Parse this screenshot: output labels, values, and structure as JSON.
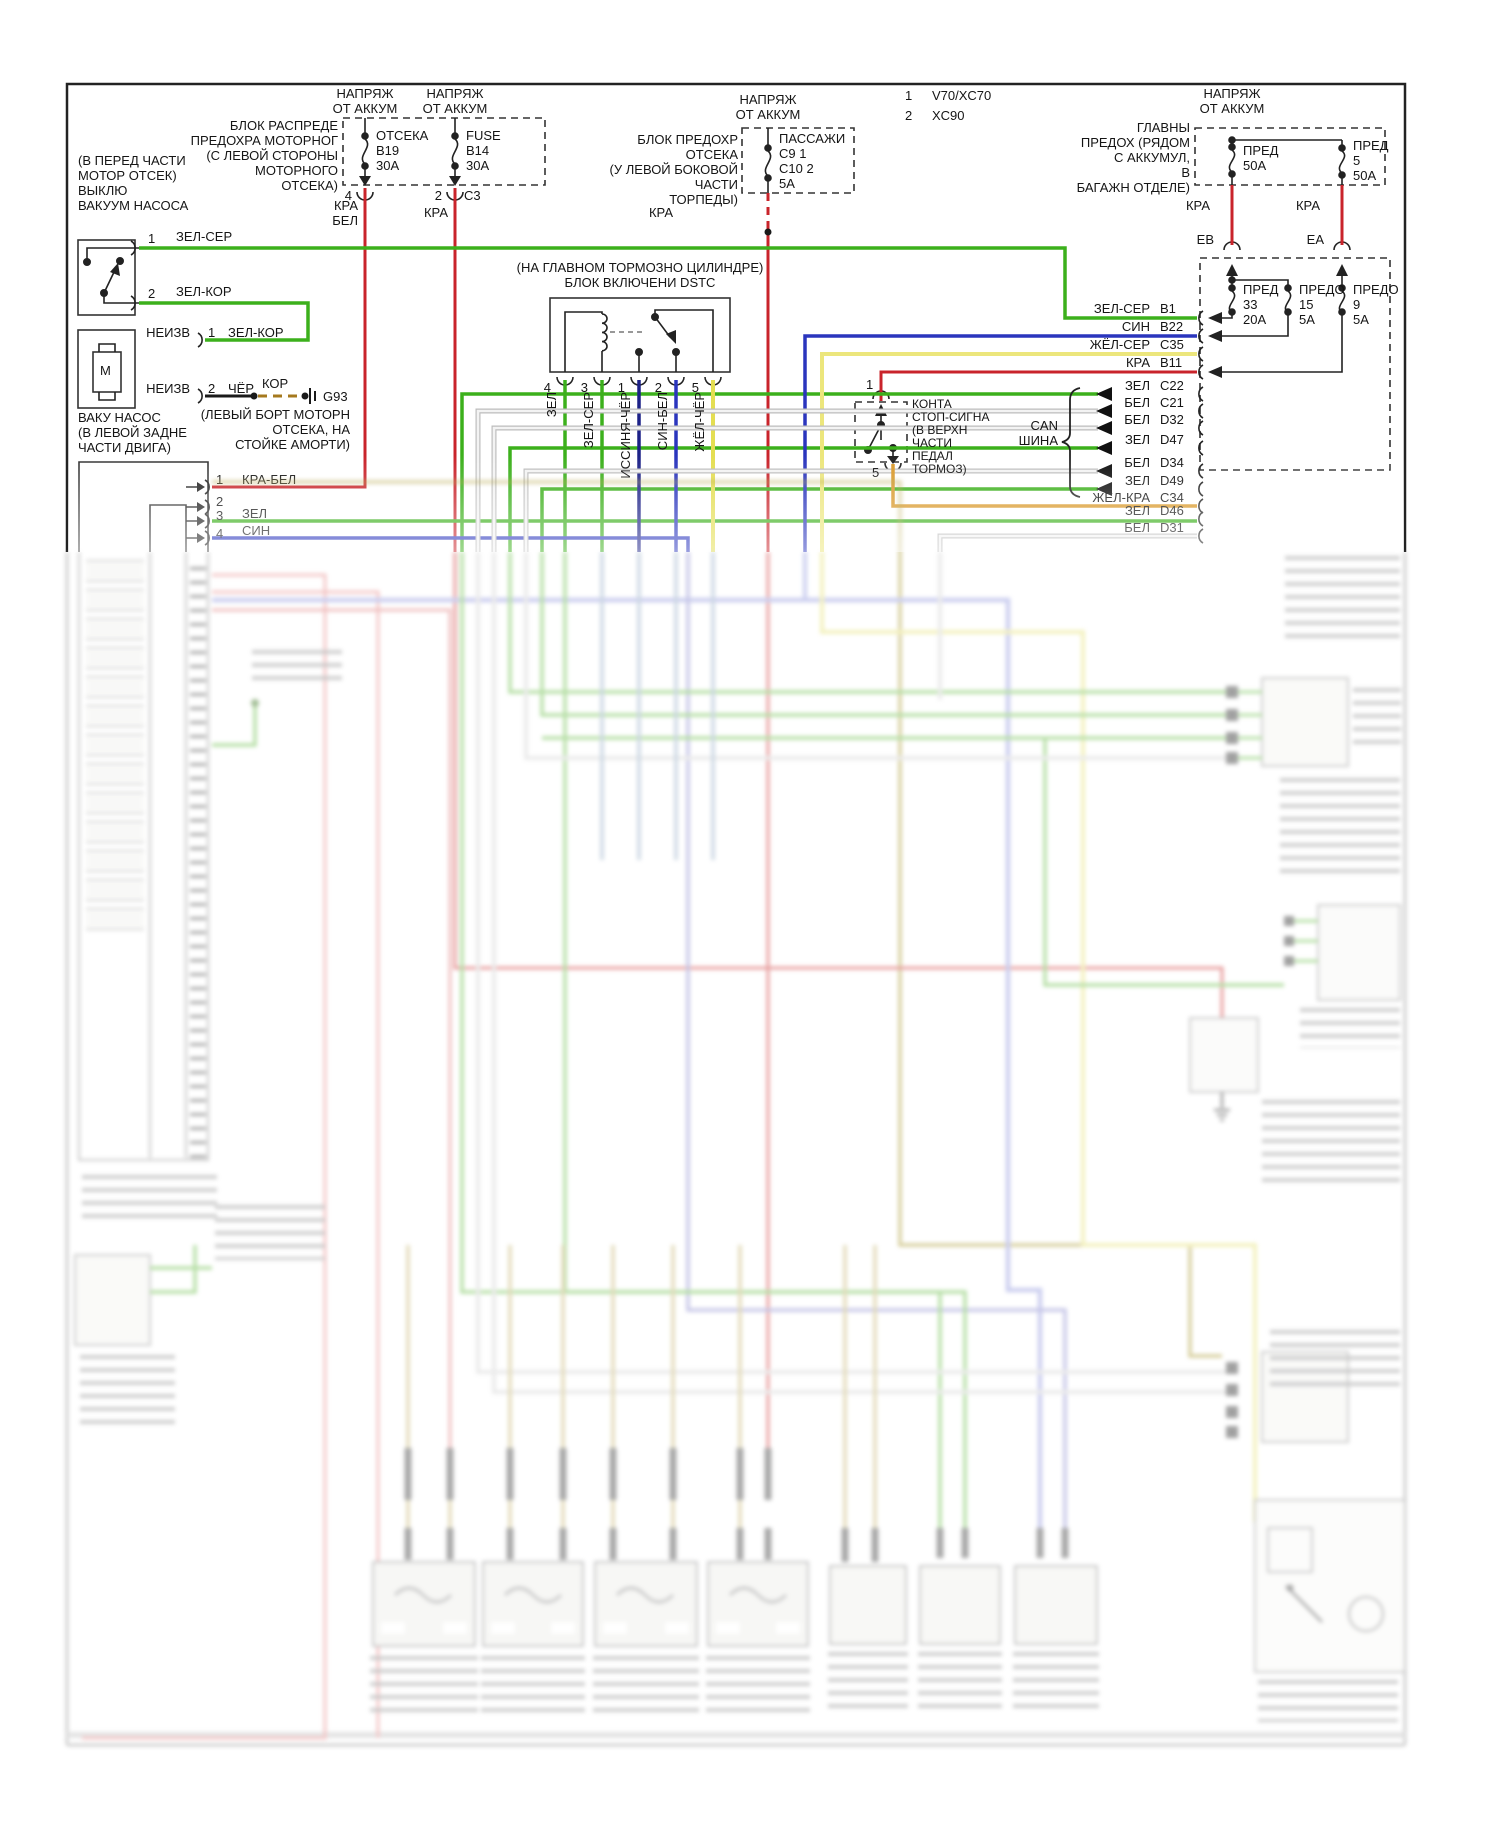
{
  "diagram": {
    "batt": "НАПРЯЖ\nОТ АККУМ",
    "legend": {
      "n1": "1",
      "v1": "V70/XC70",
      "n2": "2",
      "v2": "XC90"
    },
    "fb1": {
      "title": "БЛОК РАСПРЕДЕ\nПРЕДОХРА МОТОРНОГ\n(С ЛЕВОЙ СТОРОНЫ\nМОТОРНОГО\nОТСЕКА)",
      "f1": "ОТСЕКА\nB19\n30A",
      "f2": "FUSE\nB14\n30A",
      "p1": "4",
      "p2": "2",
      "c3": "C3",
      "w1": "КРА\nБЕЛ",
      "w2": "КРА"
    },
    "fb2": {
      "title": "БЛОК ПРЕДОХР\nОТСЕКА\n(У ЛЕВОЙ БОКОВОЙ\nЧАСТИ\nТОРПЕДЫ)",
      "f": "ПАССАЖИ\nC9   1\nC10  2\n5A",
      "w": "КРА"
    },
    "mf": {
      "title": "ГЛАВНЫ\nПРЕДОХ (РЯДОМ\nС АККУМУЛ,\nВ\nБАГАЖН ОТДЕЛЕ)",
      "f1": "ПРЕД\n50A",
      "f2": "ПРЕД\n5\n50A",
      "w": "КРА",
      "eb": "ЕВ",
      "ea": "ЕА"
    },
    "fb3": {
      "f1": "ПРЕД\n33\n20A",
      "f2": "ПРЕДО\n15\n5A",
      "f3": "ПРЕДО\n9\n5A"
    },
    "vsw": {
      "loc": "(В ПЕРЕД ЧАСТИ\nМОТОР ОТСЕК)\nВЫКЛЮ\nВАКУУМ НАСОСА",
      "p1": "1",
      "w1": "ЗЕЛ-СЕР",
      "p2": "2",
      "w2": "ЗЕЛ-КОР"
    },
    "pump": {
      "name": "ВАКУ НАСОС\n(В ЛЕВОЙ ЗАДНЕ\nЧАСТИ ДВИГА)",
      "m": "М",
      "u": "НЕИЗВ",
      "p1": "1",
      "w1": "ЗЕЛ-КОР",
      "p2": "2",
      "w2": "ЧЁР",
      "kor": "КОР",
      "gnd": "G93",
      "gnd_loc": "(ЛЕВЫЙ БОРТ МОТОРН\nОТСЕКА, НА\nСТОЙКЕ АМОРТИ)"
    },
    "ecu": {
      "p1": "1",
      "w1": "КРА-БЕЛ",
      "p2": "2",
      "p3": "3",
      "w3": "ЗЕЛ",
      "p4": "4",
      "w4": "СИН"
    },
    "dstc": {
      "title": "(НА ГЛАВНОМ ТОРМОЗНО ЦИЛИНДРЕ)\nБЛОК ВКЛЮЧЕНИ DSTC",
      "pins": [
        {
          "n": "4",
          "w": "ЗЕЛ"
        },
        {
          "n": "3",
          "w": "ЗЕЛ-СЕР"
        },
        {
          "n": "1",
          "w": "ИССИНЯ-ЧЁР"
        },
        {
          "n": "2",
          "w": "СИН-БЕЛ"
        },
        {
          "n": "5",
          "w": "ЖЁЛ-ЧЁР"
        }
      ]
    },
    "brake": {
      "p1": "1",
      "p5": "5",
      "label": "КОНТА\nСТОП-СИГНА\n(В ВЕРХН\nЧАСТИ\nПЕДАЛ\nТОРМОЗ)"
    },
    "can": "CAN\nШИНА",
    "rows": [
      {
        "w": "ЗЕЛ-СЕР",
        "p": "B1"
      },
      {
        "w": "СИН",
        "p": "B22"
      },
      {
        "w": "ЖЁЛ-СЕР",
        "p": "C35"
      },
      {
        "w": "КРА",
        "p": "B11"
      },
      {
        "w": "ЗЕЛ",
        "p": "C22"
      },
      {
        "w": "БЕЛ",
        "p": "C21"
      },
      {
        "w": "БЕЛ",
        "p": "D32"
      },
      {
        "w": "ЗЕЛ",
        "p": "D47"
      },
      {
        "w": "БЕЛ",
        "p": "D34"
      },
      {
        "w": "ЗЕЛ",
        "p": "D49"
      },
      {
        "w": "ЖЁЛ-КРА",
        "p": "C34"
      },
      {
        "w": "ЗЕЛ",
        "p": "D46"
      },
      {
        "w": "БЕЛ",
        "p": "D31"
      }
    ],
    "colors": {
      "red": "#c9242b",
      "green": "#3cb01c",
      "blue": "#2a35bd",
      "dkblue": "#1c2187",
      "yellow": "#ece67c",
      "yelblk": "#e4de52",
      "orange": "#d9992b",
      "white_wire": "#e9e9e9",
      "black": "#1a1a1a",
      "brown": "#a5791e"
    }
  }
}
